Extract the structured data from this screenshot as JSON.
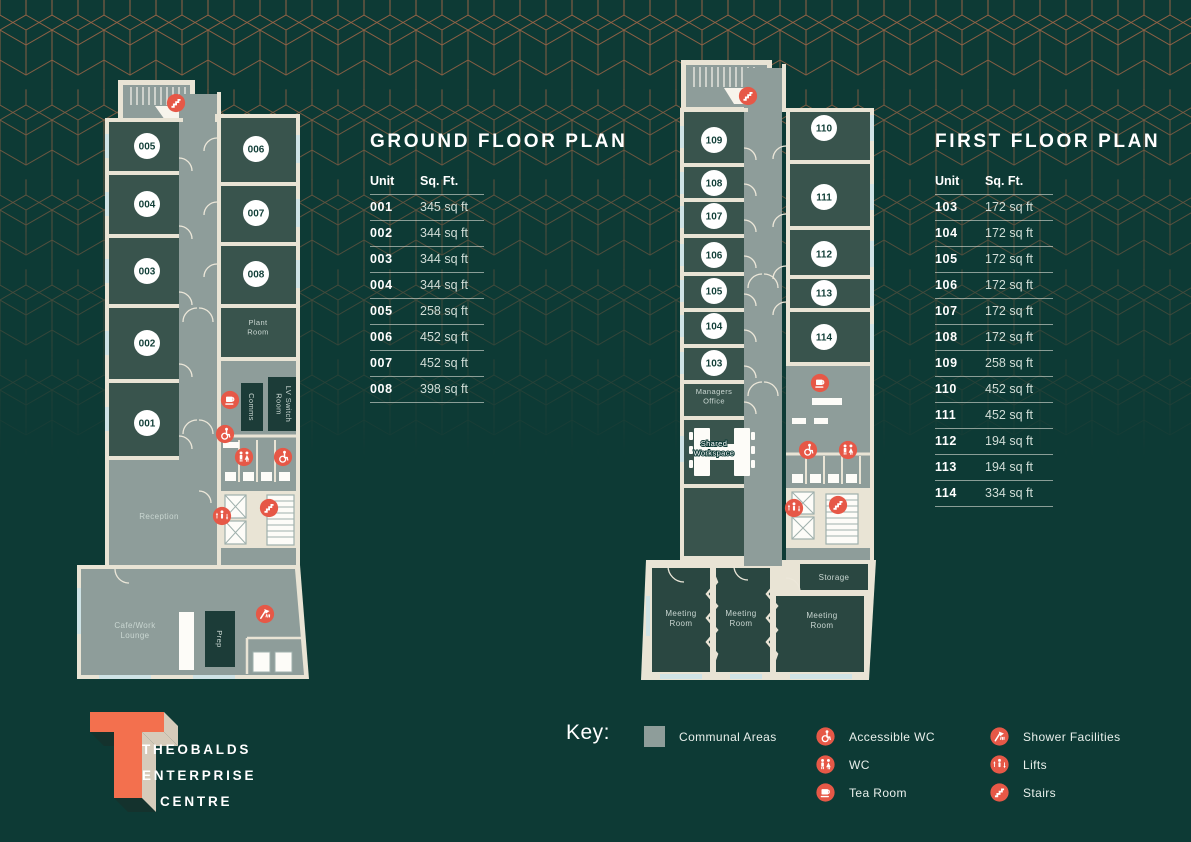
{
  "ground_floor": {
    "title": "GROUND FLOOR PLAN",
    "table": {
      "col_unit": "Unit",
      "col_sqft": "Sq. Ft.",
      "rows": [
        {
          "unit": "001",
          "sqft": "345 sq ft"
        },
        {
          "unit": "002",
          "sqft": "344 sq ft"
        },
        {
          "unit": "003",
          "sqft": "344 sq ft"
        },
        {
          "unit": "004",
          "sqft": "344 sq ft"
        },
        {
          "unit": "005",
          "sqft": "258 sq ft"
        },
        {
          "unit": "006",
          "sqft": "452 sq ft"
        },
        {
          "unit": "007",
          "sqft": "452 sq ft"
        },
        {
          "unit": "008",
          "sqft": "398 sq ft"
        }
      ]
    },
    "plan": {
      "left_units": [
        "005",
        "004",
        "003",
        "002",
        "001"
      ],
      "right_units": [
        "006",
        "007",
        "008"
      ],
      "rooms": {
        "plant": [
          "Plant",
          "Room"
        ],
        "comms": "Comms",
        "lv_switch": [
          "LV Switch",
          "Room"
        ],
        "reception": "Reception",
        "cafe": [
          "Cafe/Work",
          "Lounge"
        ],
        "prep": "Prep"
      }
    }
  },
  "first_floor": {
    "title": "FIRST FLOOR PLAN",
    "table": {
      "col_unit": "Unit",
      "col_sqft": "Sq. Ft.",
      "rows": [
        {
          "unit": "103",
          "sqft": "172 sq ft"
        },
        {
          "unit": "104",
          "sqft": "172 sq ft"
        },
        {
          "unit": "105",
          "sqft": "172 sq ft"
        },
        {
          "unit": "106",
          "sqft": "172 sq ft"
        },
        {
          "unit": "107",
          "sqft": "172 sq ft"
        },
        {
          "unit": "108",
          "sqft": "172 sq ft"
        },
        {
          "unit": "109",
          "sqft": "258 sq ft"
        },
        {
          "unit": "110",
          "sqft": "452 sq ft"
        },
        {
          "unit": "111",
          "sqft": "452 sq ft"
        },
        {
          "unit": "112",
          "sqft": "194 sq ft"
        },
        {
          "unit": "113",
          "sqft": "194 sq ft"
        },
        {
          "unit": "114",
          "sqft": "334 sq ft"
        }
      ]
    },
    "plan": {
      "left_units": [
        "109",
        "108",
        "107",
        "106",
        "105",
        "104",
        "103"
      ],
      "right_units": [
        "110",
        "111",
        "112",
        "113",
        "114"
      ],
      "rooms": {
        "managers": [
          "Managers",
          "Office"
        ],
        "shared": [
          "Shared",
          "Workspace"
        ],
        "storage": "Storage",
        "meeting": [
          "Meeting",
          "Room"
        ]
      }
    }
  },
  "key": {
    "label": "Key:",
    "communal_label": "Communal Areas",
    "items_col1": [
      {
        "icon": "accessible-wc-icon",
        "label": "Accessible WC"
      },
      {
        "icon": "wc-icon",
        "label": "WC"
      },
      {
        "icon": "tea-room-icon",
        "label": "Tea Room"
      }
    ],
    "items_col2": [
      {
        "icon": "shower-icon",
        "label": "Shower Facilities"
      },
      {
        "icon": "lifts-icon",
        "label": "Lifts"
      },
      {
        "icon": "stairs-icon",
        "label": "Stairs"
      }
    ]
  },
  "logo": {
    "line1": "THEOBALDS",
    "line2": "ENTERPRISE",
    "line3": "CENTRE"
  },
  "colors": {
    "background": "#0d3a35",
    "pattern_copper": "#b06b49",
    "wall": "#e9e4d5",
    "communal": "#8e9d9a",
    "window": "#cfe3e6",
    "icon_red": "#e65847",
    "logo_orange": "#f3704e",
    "logo_beige": "#d6cbba"
  }
}
